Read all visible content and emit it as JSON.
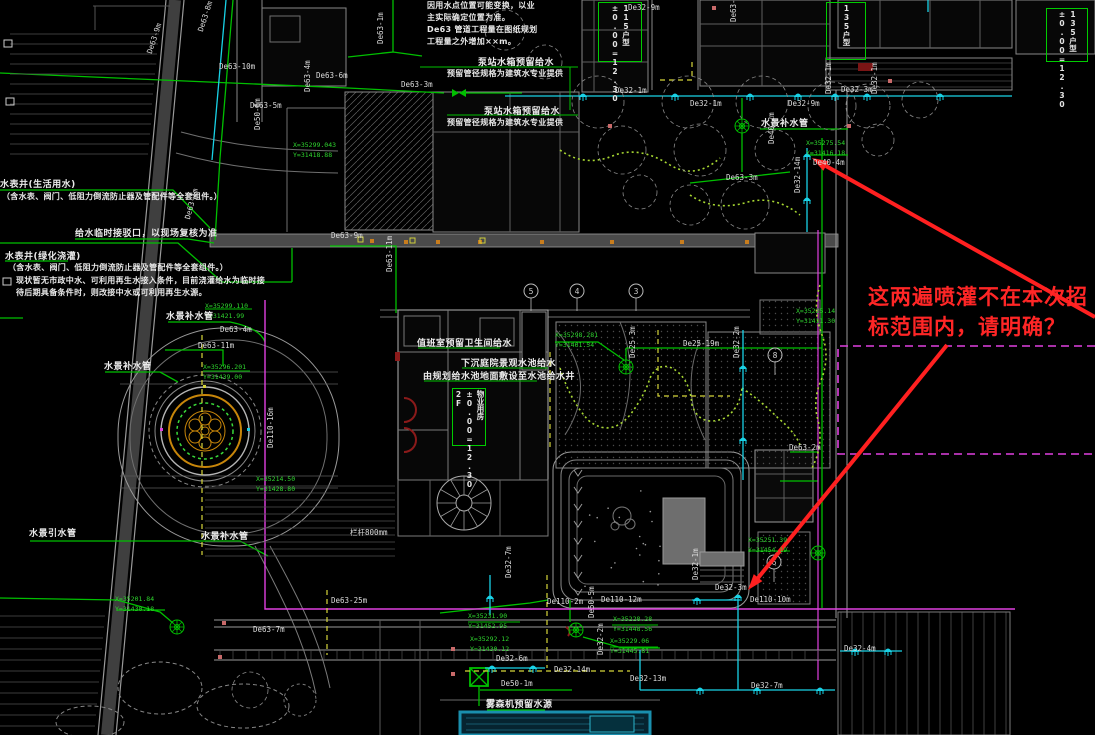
{
  "colors": {
    "background": "#000000",
    "linework_gray": "#8a8a8a",
    "pipe_green": "#00c000",
    "pipe_cyan": "#19d2e6",
    "boundary_magenta": "#e040e0",
    "drip_yellowgreen": "#a8d832",
    "aux_yellow": "#d6d63a",
    "annotation_red": "#ff2626",
    "fountain_orange": "#c8860a",
    "pool_blue_border": "#1a8fae"
  },
  "annotation": {
    "line1": "这两遍喷灌不在本次招",
    "line2": "标范围内，请明确？"
  },
  "notes": [
    {
      "x": 427,
      "y": 0,
      "lines": [
        "因用水点位置可能变换，以业",
        "主实际确定位置为准。",
        "De63 管道工程量在图纸规划",
        "工程量之外增加××m。"
      ]
    },
    {
      "x": 2,
      "y": 191,
      "lines": [
        "（含水表、阀门、低阻力倒流防止器及管配件等全套组件。）"
      ]
    },
    {
      "x": 8,
      "y": 262,
      "lines": [
        "（含水表、阀门、低阻力倒流防止器及管配件等全套组件。）"
      ]
    },
    {
      "x": 16,
      "y": 275,
      "lines": [
        "现状暂无市政中水、可利用再生水接入条件，目前浇灌给水为临时接",
        "待后期具备条件时，则改接中水或可利用再生水源。"
      ]
    },
    {
      "x": 447,
      "y": 68,
      "lines": [
        "预留管径规格为建筑水专业提供"
      ]
    },
    {
      "x": 447,
      "y": 117,
      "lines": [
        "预留管径规格为建筑水专业提供"
      ]
    }
  ],
  "labels": [
    {
      "t": "水表井(生活用水)",
      "x": 0,
      "y": 177
    },
    {
      "t": "水表井(绿化浇灌)",
      "x": 5,
      "y": 249
    },
    {
      "t": "给水临时接驳口，以现场复核为准",
      "x": 75,
      "y": 226
    },
    {
      "t": "泵站水箱预留给水",
      "x": 478,
      "y": 55
    },
    {
      "t": "泵站水箱预留给水",
      "x": 484,
      "y": 104
    },
    {
      "t": "值班室预留卫生间给水",
      "x": 417,
      "y": 336
    },
    {
      "t": "下沉庭院景观水池给水",
      "x": 461,
      "y": 356
    },
    {
      "t": "由规划给水池地面敷设至水池给水井",
      "x": 423,
      "y": 369
    },
    {
      "t": "水景补水管",
      "x": 166,
      "y": 309
    },
    {
      "t": "水景补水管",
      "x": 104,
      "y": 359
    },
    {
      "t": "水景补水管",
      "x": 201,
      "y": 529
    },
    {
      "t": "水景引水管",
      "x": 29,
      "y": 526
    },
    {
      "t": "水景补水管",
      "x": 761,
      "y": 116
    },
    {
      "t": "雾森机预留水源",
      "x": 486,
      "y": 697
    }
  ],
  "pipe_labels": [
    {
      "t": "De63-9m",
      "x": 145,
      "y": 52,
      "r": -72
    },
    {
      "t": "De63-8m",
      "x": 196,
      "y": 30,
      "r": -72
    },
    {
      "t": "De63-10m",
      "x": 219,
      "y": 62,
      "r": 0
    },
    {
      "t": "De63-5m",
      "x": 250,
      "y": 101,
      "r": 0
    },
    {
      "t": "De63-6m",
      "x": 316,
      "y": 71,
      "r": 0
    },
    {
      "t": "De63-1m",
      "x": 376,
      "y": 44,
      "r": -90
    },
    {
      "t": "De63-3m",
      "x": 401,
      "y": 80,
      "r": 0
    },
    {
      "t": "De63-4m",
      "x": 303,
      "y": 92,
      "r": -90
    },
    {
      "t": "De50-6m",
      "x": 253,
      "y": 130,
      "r": -90
    },
    {
      "t": "De63-1m",
      "x": 183,
      "y": 218,
      "r": -75
    },
    {
      "t": "De32-9m",
      "x": 628,
      "y": 3,
      "r": 0
    },
    {
      "t": "De63-10m",
      "x": 729,
      "y": 22,
      "r": -90
    },
    {
      "t": "De32-1m",
      "x": 615,
      "y": 86,
      "r": 0
    },
    {
      "t": "De32-1m",
      "x": 690,
      "y": 99,
      "r": 0
    },
    {
      "t": "De32-9m",
      "x": 788,
      "y": 99,
      "r": 0
    },
    {
      "t": "De32-3m",
      "x": 841,
      "y": 85,
      "r": 0
    },
    {
      "t": "De32-1m",
      "x": 824,
      "y": 94,
      "r": -90
    },
    {
      "t": "De32-1m",
      "x": 870,
      "y": 94,
      "r": -90
    },
    {
      "t": "De40-2m",
      "x": 767,
      "y": 144,
      "r": -90
    },
    {
      "t": "De40-4m",
      "x": 813,
      "y": 158,
      "r": 0
    },
    {
      "t": "De32-14m",
      "x": 793,
      "y": 193,
      "r": -90
    },
    {
      "t": "De63-3m",
      "x": 726,
      "y": 173,
      "r": 0
    },
    {
      "t": "De63-9m",
      "x": 331,
      "y": 231,
      "r": 0
    },
    {
      "t": "De63-11m",
      "x": 385,
      "y": 272,
      "r": -90
    },
    {
      "t": "De63-11m",
      "x": 198,
      "y": 341,
      "r": 0
    },
    {
      "t": "De63-4m",
      "x": 220,
      "y": 325,
      "r": 0
    },
    {
      "t": "De25-19m",
      "x": 683,
      "y": 339,
      "r": 0
    },
    {
      "t": "De25-3m",
      "x": 628,
      "y": 358,
      "r": -90
    },
    {
      "t": "De32-2m",
      "x": 732,
      "y": 358,
      "r": -90
    },
    {
      "t": "De110-16m",
      "x": 266,
      "y": 448,
      "r": -90
    },
    {
      "t": "De63-2m",
      "x": 789,
      "y": 443,
      "r": 0
    },
    {
      "t": "栏杆800mm",
      "x": 350,
      "y": 527,
      "r": 0
    },
    {
      "t": "De63-25m",
      "x": 331,
      "y": 596,
      "r": 0
    },
    {
      "t": "De63-7m",
      "x": 253,
      "y": 625,
      "r": 0
    },
    {
      "t": "De32-7m",
      "x": 504,
      "y": 578,
      "r": -90
    },
    {
      "t": "De110-2m",
      "x": 547,
      "y": 597,
      "r": 0
    },
    {
      "t": "De110-12m",
      "x": 601,
      "y": 595,
      "r": 0
    },
    {
      "t": "De32-1m",
      "x": 691,
      "y": 580,
      "r": -90
    },
    {
      "t": "De32-3m",
      "x": 715,
      "y": 583,
      "r": 0
    },
    {
      "t": "De110-10m",
      "x": 750,
      "y": 595,
      "r": 0
    },
    {
      "t": "De50-5m",
      "x": 587,
      "y": 618,
      "r": -90
    },
    {
      "t": "De32-6m",
      "x": 496,
      "y": 654,
      "r": 0
    },
    {
      "t": "De32-14m",
      "x": 554,
      "y": 665,
      "r": 0
    },
    {
      "t": "De32-2m",
      "x": 596,
      "y": 655,
      "r": -90
    },
    {
      "t": "De32-13m",
      "x": 630,
      "y": 674,
      "r": 0
    },
    {
      "t": "De50-1m",
      "x": 501,
      "y": 679,
      "r": 0
    },
    {
      "t": "De32-7m",
      "x": 751,
      "y": 681,
      "r": 0
    },
    {
      "t": "De32-4m",
      "x": 844,
      "y": 644,
      "r": 0
    }
  ],
  "coordinates": [
    {
      "x": 205,
      "y": 301,
      "xl": "X=35299.110",
      "yl": "Y=31421.99"
    },
    {
      "x": 203,
      "y": 362,
      "xl": "X=35296.201",
      "yl": "Y=31439.00"
    },
    {
      "x": 555,
      "y": 330,
      "xl": "X=35298.281",
      "yl": "Y=31461.54"
    },
    {
      "x": 293,
      "y": 140,
      "xl": "X=35299.043",
      "yl": "Y=31418.88"
    },
    {
      "x": 748,
      "y": 535,
      "xl": "X=35251.39",
      "yl": "Y=31454.19"
    },
    {
      "x": 806,
      "y": 138,
      "xl": "X=35275.54",
      "yl": "Y=31416.18"
    },
    {
      "x": 468,
      "y": 611,
      "xl": "X=35231.90",
      "yl": "Y=31452.95"
    },
    {
      "x": 470,
      "y": 634,
      "xl": "X=35292.12",
      "yl": "Y=31430.12"
    },
    {
      "x": 613,
      "y": 614,
      "xl": "X=35228.28",
      "yl": "Y=31448.56"
    },
    {
      "x": 610,
      "y": 636,
      "xl": "X=35229.06",
      "yl": "Y=31445.81"
    },
    {
      "x": 115,
      "y": 594,
      "xl": "X=35201.84",
      "yl": "Y=31430.18"
    },
    {
      "x": 796,
      "y": 306,
      "xl": "X=35225.14",
      "yl": "Y=31411.30"
    },
    {
      "x": 256,
      "y": 474,
      "xl": "X=35214.50",
      "yl": "Y=31428.80"
    }
  ],
  "axis_bubbles": [
    {
      "n": "5",
      "x": 531,
      "y": 291
    },
    {
      "n": "4",
      "x": 577,
      "y": 291
    },
    {
      "n": "3",
      "x": 636,
      "y": 291
    },
    {
      "n": "8",
      "x": 775,
      "y": 355
    },
    {
      "n": "6",
      "x": 774,
      "y": 562
    }
  ],
  "building_boxes": [
    {
      "x": 598,
      "y": 2,
      "w": 40,
      "h": 56,
      "lines": [
        "115户型",
        "±0.00=12.30"
      ]
    },
    {
      "x": 826,
      "y": 2,
      "w": 36,
      "h": 54,
      "lines": [
        "135户型"
      ]
    },
    {
      "x": 1046,
      "y": 8,
      "w": 38,
      "h": 50,
      "lines": [
        "135户型",
        "±0.00=12.30"
      ]
    },
    {
      "x": 452,
      "y": 388,
      "w": 30,
      "h": 54,
      "lines": [
        "物业用房",
        "±0.00=12.30",
        "2F"
      ]
    }
  ]
}
